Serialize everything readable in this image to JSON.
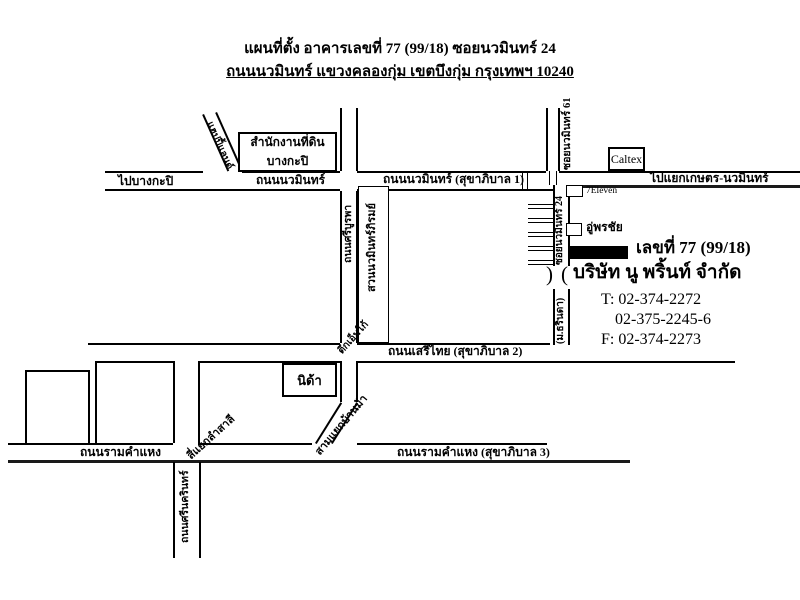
{
  "colors": {
    "ink": "#000000",
    "paper": "#ffffff"
  },
  "title": {
    "line1": "แผนที่ตั้ง อาคารเลขที่  77 (99/18) ซอยนวมินทร์ 24",
    "line2": "ถนนนวมินทร์  แขวงคลองกุ่ม  เขตบึงกุ่ม  กรุงเทพฯ 10240"
  },
  "roads": {
    "to_bangkapi": "ไปบางกะปิ",
    "nawamin": "ถนนนวมินทร์",
    "nawamin_sukha1": "ถนนนวมินทร์ (สุขาภิบาล 1)",
    "to_kaset_nawamin": "ไปแยกเกษตร-นวมินทร์",
    "happy_land": "แฮปปี้แลนด์",
    "soi_nawamin_61": "ซอยนวมินทร์ 61",
    "soi_nawamin_24": "ซอยนวมินทร์ 24",
    "sri_burapha": "ถนนศรีบูรพา",
    "seri_thai": "ถนนเสรีไทย (สุขาภิบาล 2)",
    "ramkhamhaeng": "ถนนรามคำแหง",
    "ramkhamhaeng_sukha3": "ถนนรามคำแหง (สุขาภิบาล 3)",
    "srinakarin": "ถนนศรีนครินทร์",
    "lam_sali_junction": "สี่แยกลำสาลี",
    "ban_ma_junction": "สามแยกบ้านม้า",
    "village": "(ม.ธรินดา)"
  },
  "places": {
    "land_office_line1": "สำนักงานที่ดิน",
    "land_office_line2": "บางกะปิ",
    "caltex": "Caltex",
    "seven_eleven": "7Eleven",
    "garage": "อู่พรชัย",
    "park": "สวนนวมินทร์ภิรมย์",
    "m_building": "ตึกเอ็มโก้",
    "nida": "นิด้า"
  },
  "destination": {
    "address": "เลขที่ 77 (99/18)",
    "company": "บริษัท นู พริ้นท์ จำกัด",
    "tel1": "T: 02-374-2272",
    "tel2": "02-375-2245-6",
    "fax": "F: 02-374-2273"
  }
}
